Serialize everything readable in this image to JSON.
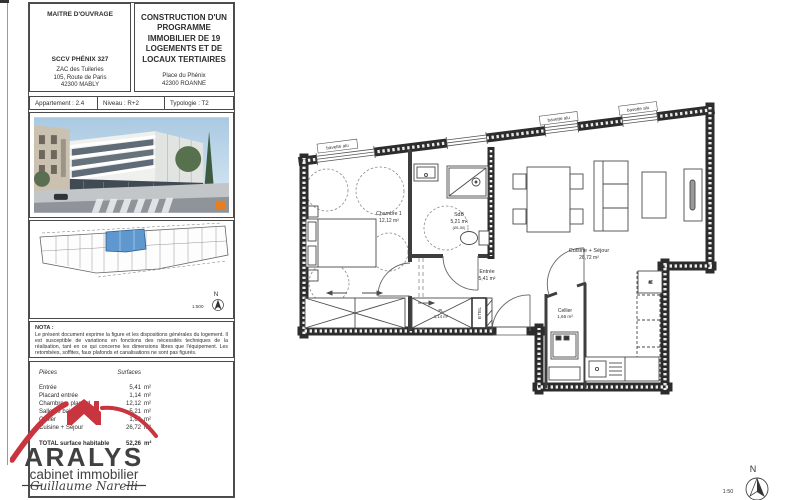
{
  "header": {
    "owner_title": "MAITRE D'OUVRAGE",
    "owner_company": "SCCV PHÉNIX 327",
    "owner_address_1": "ZAC des Tuileries",
    "owner_address_2": "105, Route de Paris",
    "owner_address_3": "42300 MABLY",
    "project_title": "CONSTRUCTION D'UN PROGRAMME IMMOBILIER DE 19 LOGEMENTS ET DE LOCAUX TERTIAIRES",
    "project_address_1": "Place du Phénix",
    "project_address_2": "42300 ROANNE"
  },
  "info_row": {
    "apartment": "Appartement :  2.4",
    "level": "Niveau :  R+2",
    "typology": "Typologie :  T2"
  },
  "key_plan": {
    "north": "N",
    "scale": "1:500"
  },
  "nota": {
    "title": "NOTA :",
    "body": "Le présent document exprime la figure et les dispositions générales du logement. Il est susceptible de variations en fonctions des nécessités techniques de la réalisation, tant en ce qui concerne les dimensions libres que l'équipement. Les retombées, soffites, faux plafonds et canalisations ne sont pas figurés."
  },
  "surface_table": {
    "header_label": "Pièces",
    "header_value": "Surfaces",
    "rows": [
      {
        "label": "Entrée",
        "value": "5,41",
        "unit": "m²"
      },
      {
        "label": "Placard entrée",
        "value": "1,14",
        "unit": "m²"
      },
      {
        "label": "Chambre + placard",
        "value": "12,12",
        "unit": "m²"
      },
      {
        "label": "Salle de bain",
        "value": "5,21",
        "unit": "m²"
      },
      {
        "label": "Cellier",
        "value": "1,66",
        "unit": "m²"
      },
      {
        "label": "Cuisine + Séjour",
        "value": "26,72",
        "unit": "m²"
      }
    ],
    "total_label": "TOTAL surface habitable",
    "total_value": "52,26",
    "total_unit": "m²"
  },
  "logo": {
    "name": "ARALYS",
    "subtitle": "cabinet immobilier",
    "signature": "Guillaume Narelli",
    "red": "#c9353f",
    "dark": "#414142"
  },
  "floor_plan": {
    "rooms": {
      "chambre": {
        "name": "Chambre 1",
        "area": "12,12 m²"
      },
      "sdb": {
        "name": "SdB",
        "area": "5,21 m²",
        "note": "(Ø1,50)"
      },
      "entree": {
        "name": "Entrée",
        "area": "5,41 m²"
      },
      "sejour": {
        "name": "Cuisine + Séjour",
        "area": "26,72 m²"
      },
      "cellier": {
        "name": "Cellier",
        "area": "1,66 m²"
      },
      "placard": {
        "name": "PL",
        "area": "1,14 m²"
      }
    },
    "labels": {
      "window_sill": "bavette alu",
      "tech_closet": "ETEL",
      "fridge": "R"
    },
    "north": "N",
    "scale": "1:50"
  }
}
